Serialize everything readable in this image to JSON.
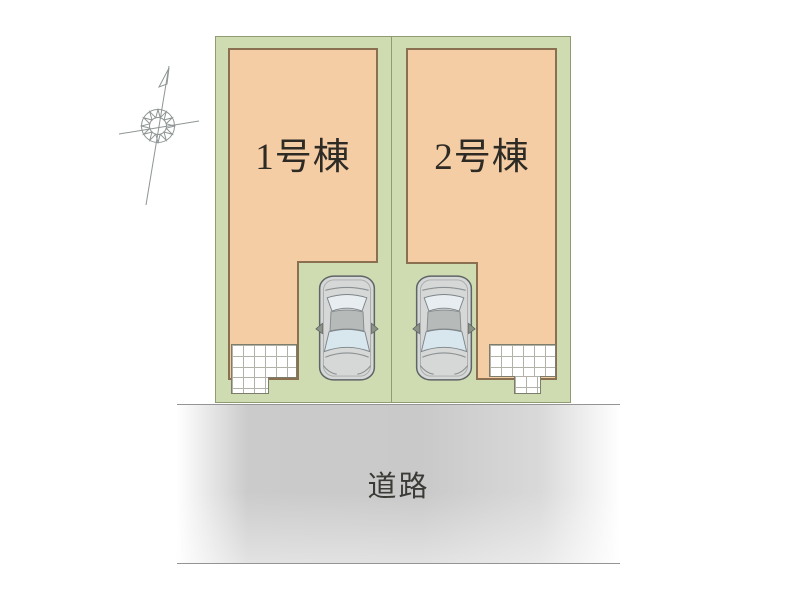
{
  "site_plan": {
    "buildings": [
      {
        "label": "1号棟"
      },
      {
        "label": "2号棟"
      }
    ],
    "road_label": "道路",
    "icons": {
      "compass": "compass-north-icon",
      "car": "car-top-view-icon",
      "tiles": "entrance-tile-grid-icon"
    }
  },
  "colors": {
    "plot_green": "#cfdcb2",
    "plot_border": "#8e9b73",
    "building_fill": "#f5cda5",
    "building_border": "#8b6f51",
    "road_gray": "#c9c9c9",
    "road_line": "#949494",
    "label_text": "#2e2b25"
  }
}
